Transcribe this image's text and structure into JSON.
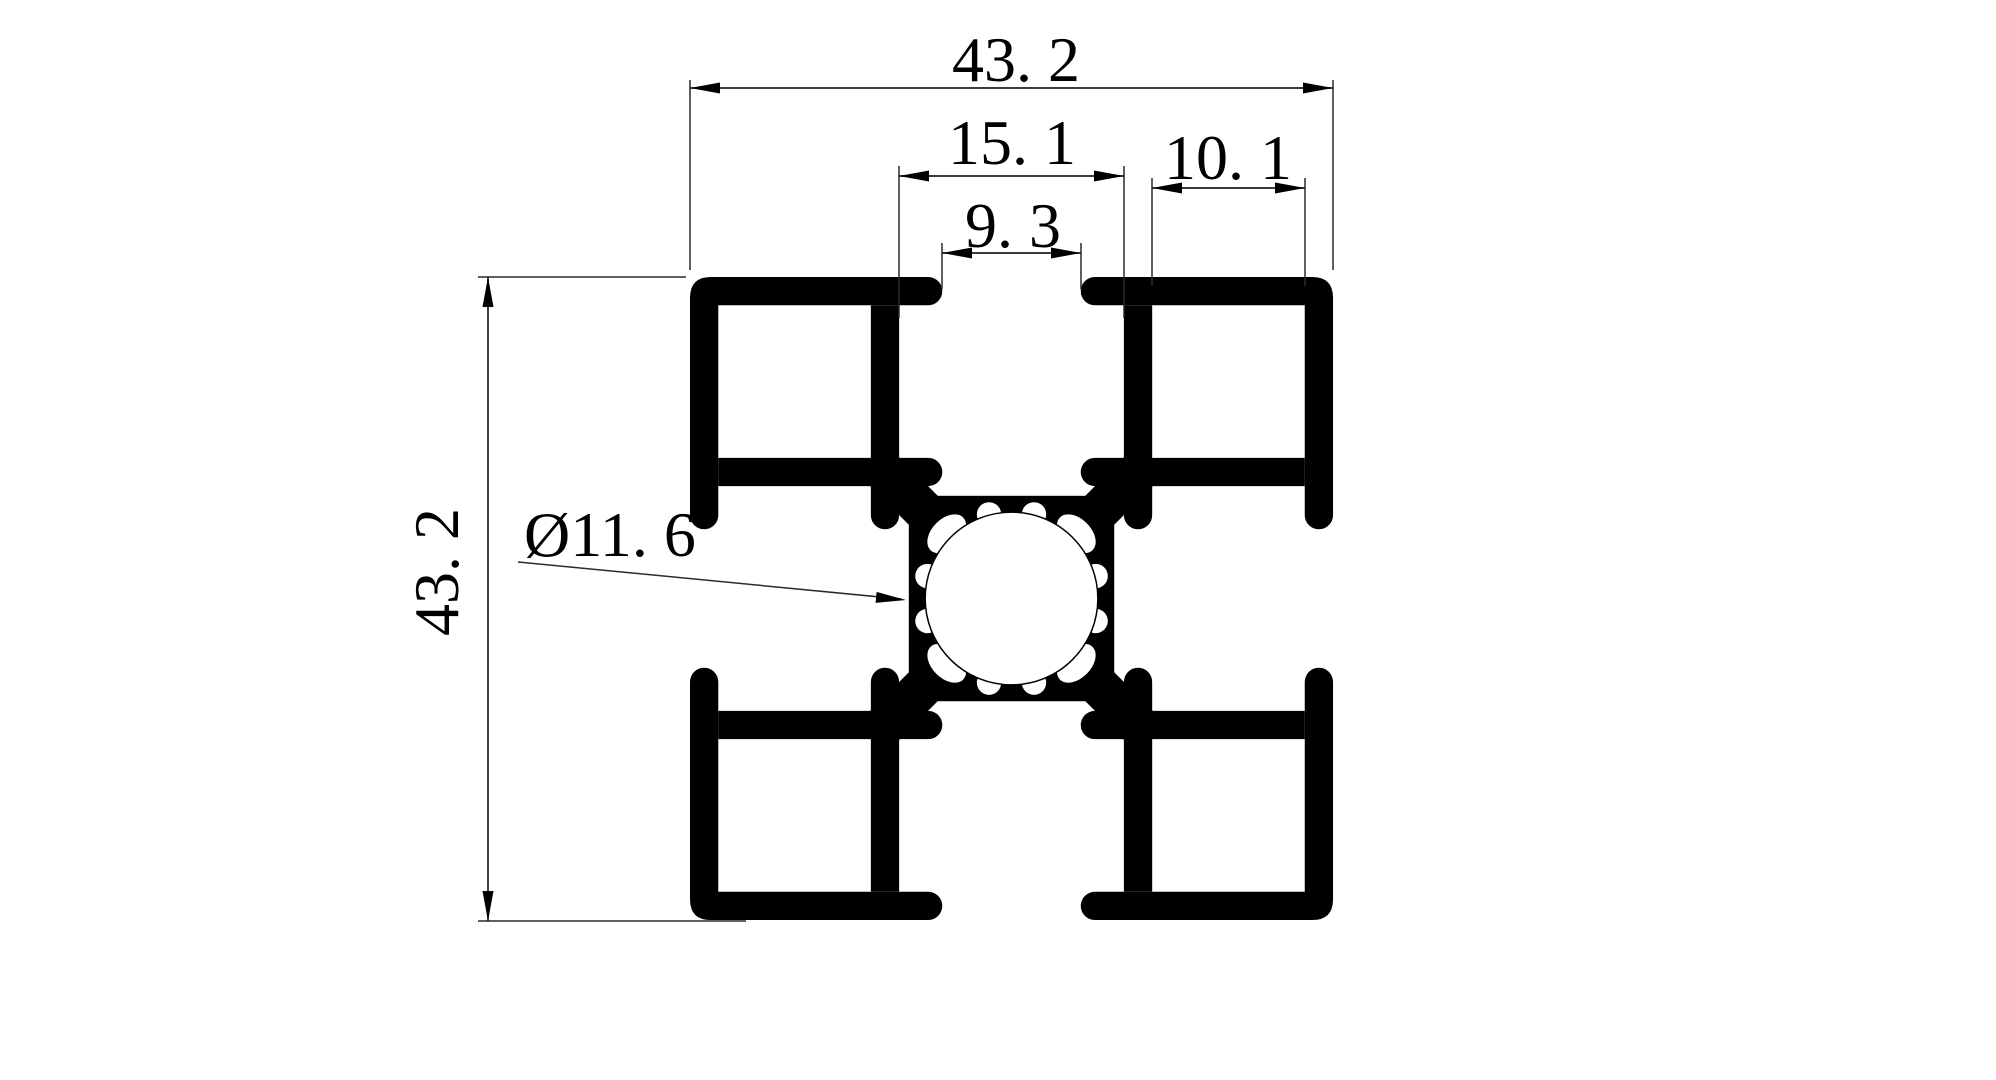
{
  "drawing": {
    "background_color": "#ffffff",
    "ink_color": "#000000",
    "thin_line_color": "#1f1f1f",
    "type": "aluminium-extrusion-profile-cross-section",
    "dimensions": {
      "overall_width": {
        "label": "43. 2",
        "value": 43.2
      },
      "overall_height": {
        "label": "43. 2",
        "value": 43.2
      },
      "slot_cavity_width": {
        "label": "15. 1",
        "value": 15.1
      },
      "slot_opening_width": {
        "label": "9. 3",
        "value": 9.3
      },
      "corner_pocket_width": {
        "label": "10. 1",
        "value": 10.1
      },
      "center_bore": {
        "label": "Ø11. 6",
        "value": 11.6
      }
    }
  }
}
